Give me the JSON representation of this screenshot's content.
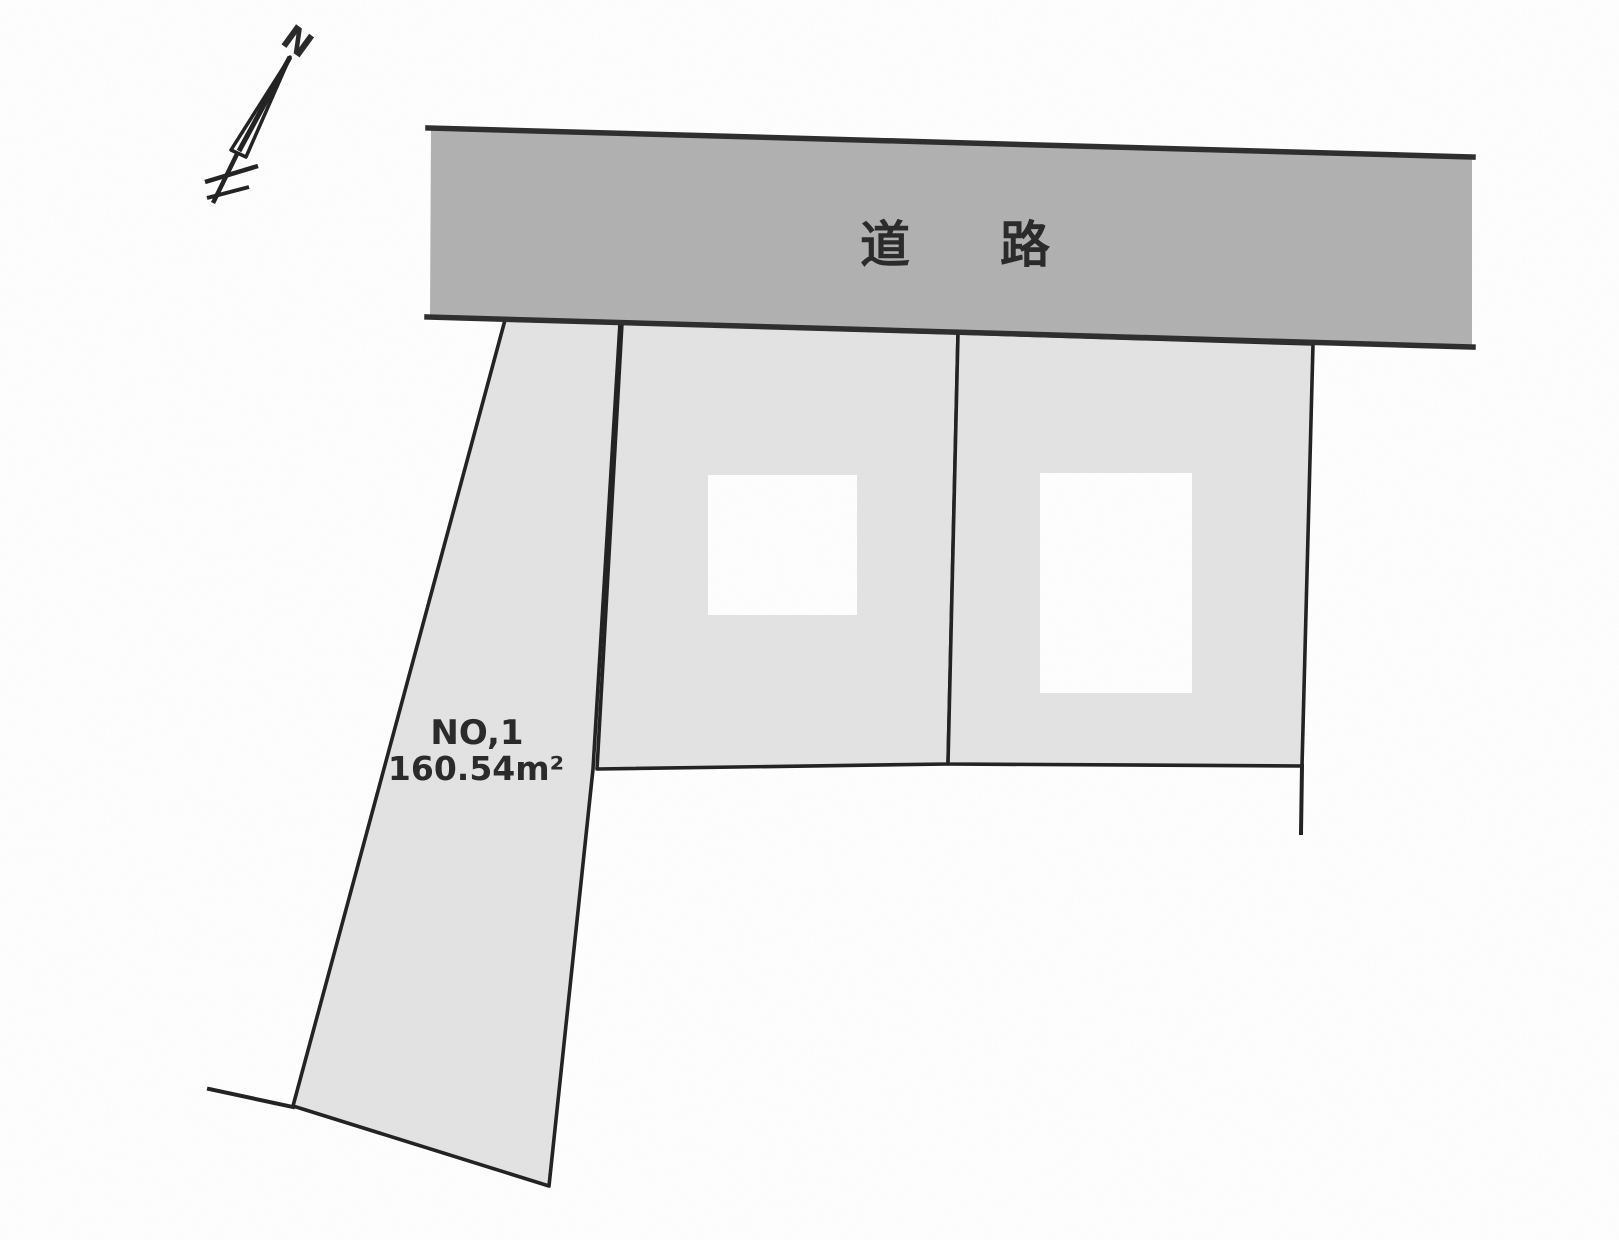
{
  "diagram": {
    "road": {
      "label": "道路"
    },
    "parcels": [
      {
        "id": "NO,1",
        "area": "160.54m²"
      }
    ],
    "compass": {
      "north_label": "N"
    }
  },
  "colors": {
    "background": "#ffffff",
    "road_fill": "#b0b0b0",
    "parcel_fill": "#e3e3e3",
    "building_fill": "#ffffff",
    "line": "#1e1e1e",
    "road_edge_line": "#2a2a2a",
    "text": "#262626"
  }
}
